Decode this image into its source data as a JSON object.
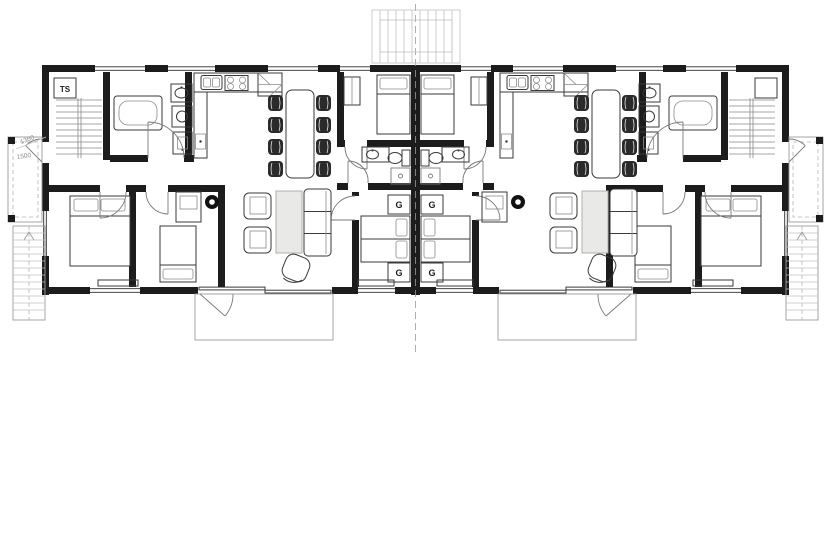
{
  "drawing": {
    "type": "architectural-floor-plan-semi-detached",
    "labels": {
      "technical_space": "TS",
      "dim_a": "1380",
      "dim_b": "1500"
    },
    "wardrobe_markers": [
      "G",
      "G",
      "G",
      "G"
    ],
    "colors": {
      "wall": "#1c1c1c",
      "furniture_line": "#3a3a3a",
      "light_line": "#9c9c9c",
      "chair_fill": "#2a2a2a",
      "table_fill": "#e9e9e7",
      "background": "#ffffff"
    }
  }
}
